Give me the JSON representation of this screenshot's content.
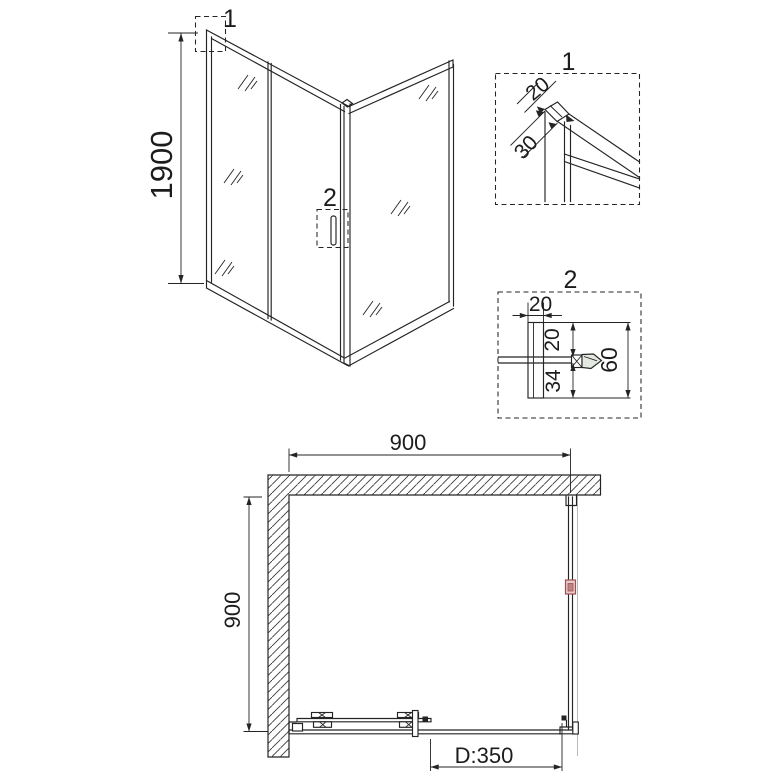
{
  "colors": {
    "line": "#242424",
    "bracket_accent_border": "#9b5252",
    "bracket_accent_fill": "#e8caca",
    "handle_fill": "#e3e9e1"
  },
  "perspective_view": {
    "height_dimension": "1900",
    "corner_callout_label": "1",
    "handle_callout_label": "2"
  },
  "detail_view_1": {
    "title": "1",
    "profile_width": "20",
    "profile_depth": "30"
  },
  "detail_view_2": {
    "title": "2",
    "profile_width": "20",
    "glass_top_offset": "20",
    "glass_bottom_offset": "34",
    "handle_total_depth": "60"
  },
  "plan_view": {
    "enclosure_width": "900",
    "enclosure_depth": "900",
    "door_opening": "D:350"
  }
}
